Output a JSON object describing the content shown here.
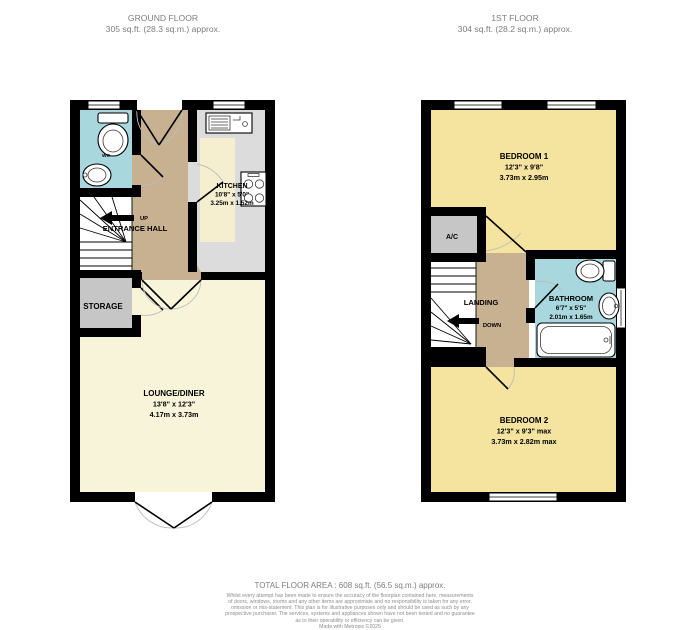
{
  "ground_floor": {
    "header": {
      "title": "GROUND FLOOR",
      "area": "305 sq.ft. (28.3 sq.m.) approx."
    },
    "rooms": {
      "wc": {
        "name": "WC"
      },
      "entrance_hall": {
        "name": "ENTRANCE HALL"
      },
      "storage": {
        "name": "STORAGE"
      },
      "kitchen": {
        "name": "KITCHEN",
        "dims_imperial": "10'8\" x 5'0\"",
        "dims_metric": "3.25m x 1.52m"
      },
      "lounge": {
        "name": "LOUNGE/DINER",
        "dims_imperial": "13'8\" x 12'3\"",
        "dims_metric": "4.17m x 3.73m"
      }
    },
    "stairs_label": "UP"
  },
  "first_floor": {
    "header": {
      "title": "1ST FLOOR",
      "area": "304 sq.ft. (28.2 sq.m.) approx."
    },
    "rooms": {
      "bedroom1": {
        "name": "BEDROOM 1",
        "dims_imperial": "12'3\" x 9'8\"",
        "dims_metric": "3.73m x 2.95m"
      },
      "ac": {
        "name": "A/C"
      },
      "landing": {
        "name": "LANDING"
      },
      "bathroom": {
        "name": "BATHROOM",
        "dims_imperial": "6'7\" x 5'5\"",
        "dims_metric": "2.01m x 1.65m"
      },
      "bedroom2": {
        "name": "BEDROOM 2",
        "dims_imperial": "12'3\" x 9'3\" max",
        "dims_metric": "3.73m x 2.82m max"
      }
    },
    "stairs_label": "DOWN"
  },
  "footer": {
    "total": "TOTAL FLOOR AREA : 608 sq.ft. (56.5 sq.m.) approx.",
    "disclaimer_lines": [
      "Whilst every attempt has been made to ensure the accuracy of the floorplan contained here, measurements",
      "of doors, windows, rooms and any other items are approximate and no responsibility is taken for any error,",
      "omission or mis-statement. This plan is for illustrative purposes only and should be used as such by any",
      "prospective purchaser. The services, systems and appliances shown have not been tested and no guarantee",
      "as to their operability or efficiency can be given."
    ],
    "credit": "Made with Metropix ©2025"
  },
  "colors": {
    "hall_tan": "#c8b190",
    "room_yellow": "#f5e3a0",
    "bath_blue": "#a8d8de",
    "kitchen_counter": "#dcdcdc",
    "floor_cream": "#f8f4da",
    "kitchen_cream": "#f5efcf",
    "closet_gray": "#c6c6c6",
    "wall_black": "#000000"
  }
}
